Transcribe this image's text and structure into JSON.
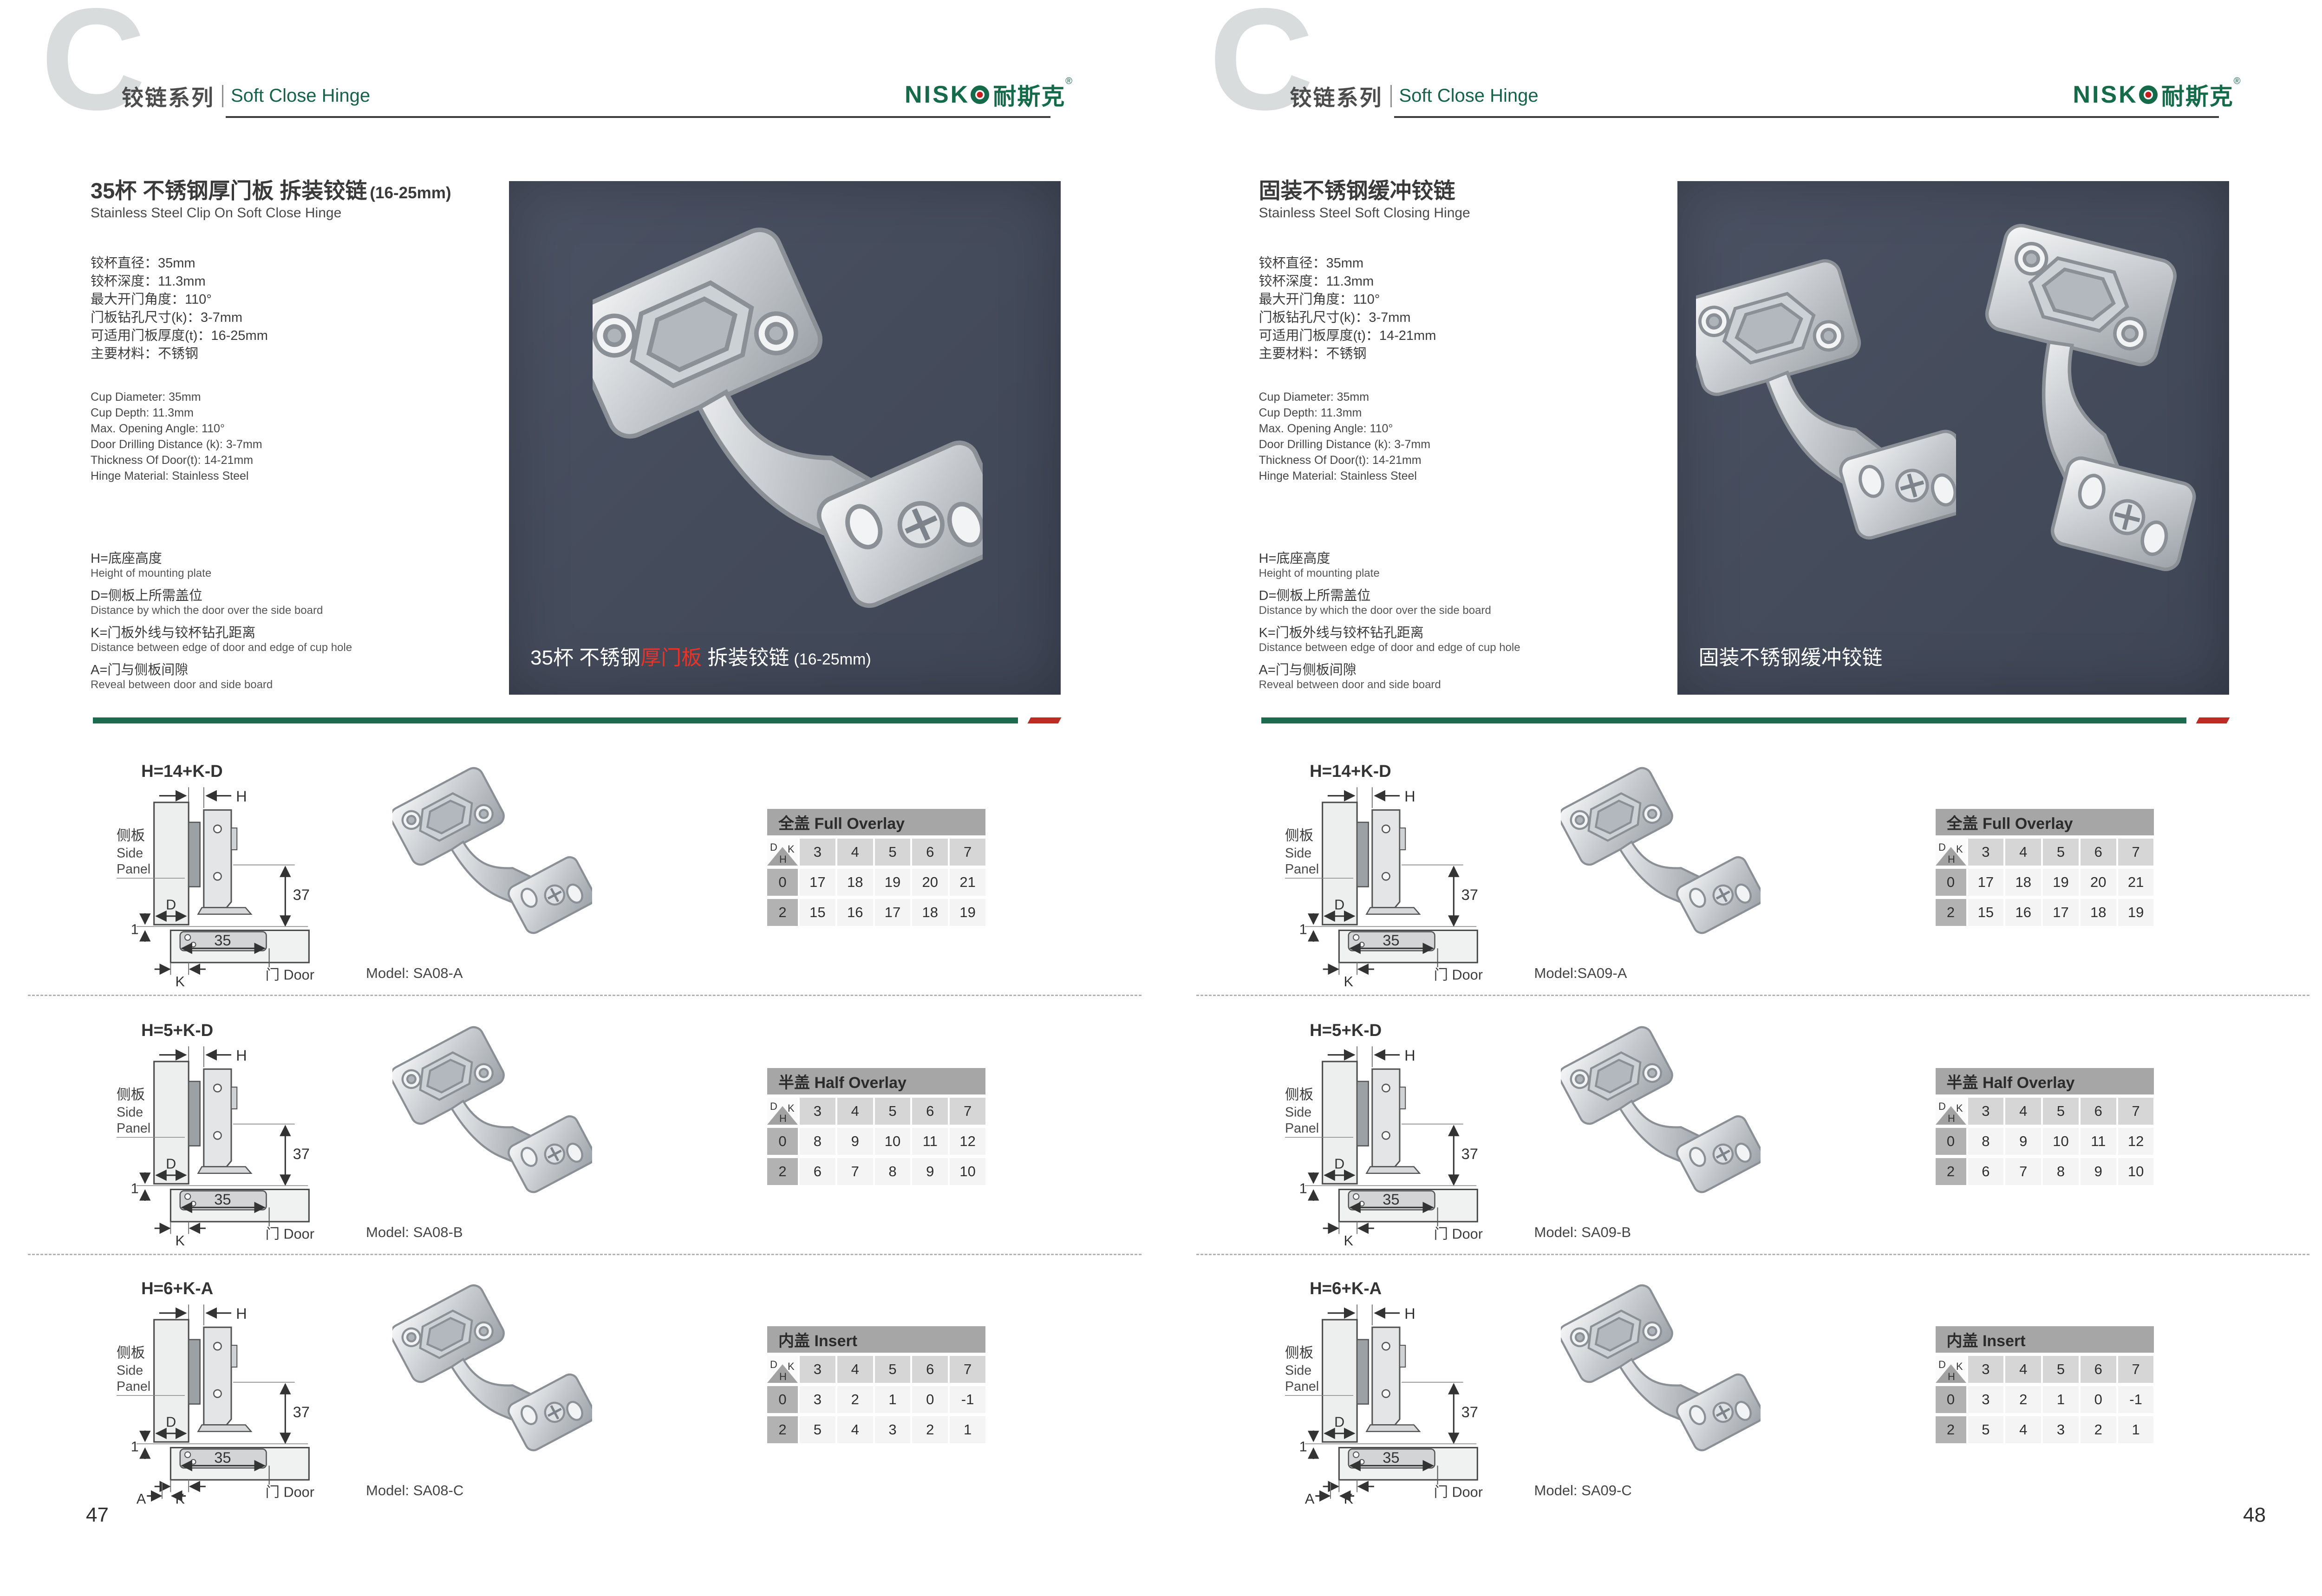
{
  "brand": {
    "name_prefix": "NISK",
    "name_cn": "耐斯克",
    "registered": "®"
  },
  "table_corner": {
    "d": "D",
    "k": "K",
    "h": "H"
  },
  "diagram_labels": {
    "h": "H",
    "d": "D",
    "k": "K",
    "a": "A",
    "gap": "1",
    "cup_width": "35",
    "plate_height": "37",
    "side_cn": "侧板",
    "side_en_1": "Side",
    "side_en_2": "Panel",
    "door": "门 Door"
  },
  "pages": [
    {
      "page_number": "47",
      "header": {
        "letter": "C",
        "series_cn": "铰链系列",
        "series_en": "Soft Close Hinge"
      },
      "product": {
        "title": "35杯 不锈钢厚门板 拆装铰链",
        "title_suffix": "(16-25mm)",
        "subtitle": "Stainless Steel Clip On Soft Close Hinge"
      },
      "specs_cn": [
        "铰杯直径：35mm",
        "铰杯深度：11.3mm",
        "最大开门角度：110°",
        "门板钻孔尺寸(k)：3-7mm",
        "可适用门板厚度(t)：16-25mm",
        "主要材料：不锈钢"
      ],
      "specs_en": [
        "Cup Diameter: 35mm",
        "Cup Depth: 11.3mm",
        "Max. Opening Angle: 110°",
        "Door Drilling Distance (k): 3-7mm",
        "Thickness Of Door(t): 14-21mm",
        "Hinge Material: Stainless Steel"
      ],
      "legend": [
        {
          "cn": "H=底座高度",
          "en": "Height of mounting plate"
        },
        {
          "cn": "D=侧板上所需盖位",
          "en": "Distance by which the door over the side board"
        },
        {
          "cn": "K=门板外线与铰杯钻孔距离",
          "en": "Distance between edge of door and edge of cup hole"
        },
        {
          "cn": "A=门与侧板间隙",
          "en": "Reveal between door and side board"
        }
      ],
      "photo_caption": {
        "pre": "35杯 不锈钢",
        "red": "厚门板",
        "post": " 拆装铰链",
        "suffix": "(16-25mm)"
      },
      "sections": [
        {
          "formula": "H=14+K-D",
          "model": "Model: SA08-A",
          "show_a": false,
          "table": {
            "title": "全盖 Full Overlay",
            "columns": [
              "3",
              "4",
              "5",
              "6",
              "7"
            ],
            "rows": [
              {
                "h": "0",
                "values": [
                  "17",
                  "18",
                  "19",
                  "20",
                  "21"
                ]
              },
              {
                "h": "2",
                "values": [
                  "15",
                  "16",
                  "17",
                  "18",
                  "19"
                ]
              }
            ]
          }
        },
        {
          "formula": "H=5+K-D",
          "model": "Model: SA08-B",
          "show_a": false,
          "table": {
            "title": "半盖 Half Overlay",
            "columns": [
              "3",
              "4",
              "5",
              "6",
              "7"
            ],
            "rows": [
              {
                "h": "0",
                "values": [
                  "8",
                  "9",
                  "10",
                  "11",
                  "12"
                ]
              },
              {
                "h": "2",
                "values": [
                  "6",
                  "7",
                  "8",
                  "9",
                  "10"
                ]
              }
            ]
          }
        },
        {
          "formula": "H=6+K-A",
          "model": "Model: SA08-C",
          "show_a": true,
          "table": {
            "title": "内盖 Insert",
            "columns": [
              "3",
              "4",
              "5",
              "6",
              "7"
            ],
            "rows": [
              {
                "h": "0",
                "values": [
                  "3",
                  "2",
                  "1",
                  "0",
                  "-1"
                ]
              },
              {
                "h": "2",
                "values": [
                  "5",
                  "4",
                  "3",
                  "2",
                  "1"
                ]
              }
            ]
          }
        }
      ]
    },
    {
      "page_number": "48",
      "header": {
        "letter": "C",
        "series_cn": "铰链系列",
        "series_en": "Soft Close Hinge"
      },
      "product": {
        "title": "固装不锈钢缓冲铰链",
        "title_suffix": "",
        "subtitle": "Stainless Steel Soft Closing Hinge"
      },
      "specs_cn": [
        "铰杯直径：35mm",
        "铰杯深度：11.3mm",
        "最大开门角度：110°",
        "门板钻孔尺寸(k)：3-7mm",
        "可适用门板厚度(t)：14-21mm",
        "主要材料：不锈钢"
      ],
      "specs_en": [
        "Cup Diameter: 35mm",
        "Cup Depth: 11.3mm",
        "Max. Opening Angle: 110°",
        "Door Drilling Distance (k): 3-7mm",
        "Thickness Of Door(t): 14-21mm",
        "Hinge Material: Stainless Steel"
      ],
      "legend": [
        {
          "cn": "H=底座高度",
          "en": "Height of mounting plate"
        },
        {
          "cn": "D=侧板上所需盖位",
          "en": "Distance by which the door over the side board"
        },
        {
          "cn": "K=门板外线与铰杯钻孔距离",
          "en": "Distance between edge of door and edge of cup hole"
        },
        {
          "cn": "A=门与侧板间隙",
          "en": "Reveal between door and side board"
        }
      ],
      "photo_caption": {
        "pre": "固装不锈钢缓冲铰链",
        "red": "",
        "post": "",
        "suffix": ""
      },
      "sections": [
        {
          "formula": "H=14+K-D",
          "model": "Model:SA09-A",
          "show_a": false,
          "table": {
            "title": "全盖 Full Overlay",
            "columns": [
              "3",
              "4",
              "5",
              "6",
              "7"
            ],
            "rows": [
              {
                "h": "0",
                "values": [
                  "17",
                  "18",
                  "19",
                  "20",
                  "21"
                ]
              },
              {
                "h": "2",
                "values": [
                  "15",
                  "16",
                  "17",
                  "18",
                  "19"
                ]
              }
            ]
          }
        },
        {
          "formula": "H=5+K-D",
          "model": "Model: SA09-B",
          "show_a": false,
          "table": {
            "title": "半盖 Half Overlay",
            "columns": [
              "3",
              "4",
              "5",
              "6",
              "7"
            ],
            "rows": [
              {
                "h": "0",
                "values": [
                  "8",
                  "9",
                  "10",
                  "11",
                  "12"
                ]
              },
              {
                "h": "2",
                "values": [
                  "6",
                  "7",
                  "8",
                  "9",
                  "10"
                ]
              }
            ]
          }
        },
        {
          "formula": "H=6+K-A",
          "model": "Model: SA09-C",
          "show_a": true,
          "table": {
            "title": "内盖 Insert",
            "columns": [
              "3",
              "4",
              "5",
              "6",
              "7"
            ],
            "rows": [
              {
                "h": "0",
                "values": [
                  "3",
                  "2",
                  "1",
                  "0",
                  "-1"
                ]
              },
              {
                "h": "2",
                "values": [
                  "5",
                  "4",
                  "3",
                  "2",
                  "1"
                ]
              }
            ]
          }
        }
      ]
    }
  ]
}
